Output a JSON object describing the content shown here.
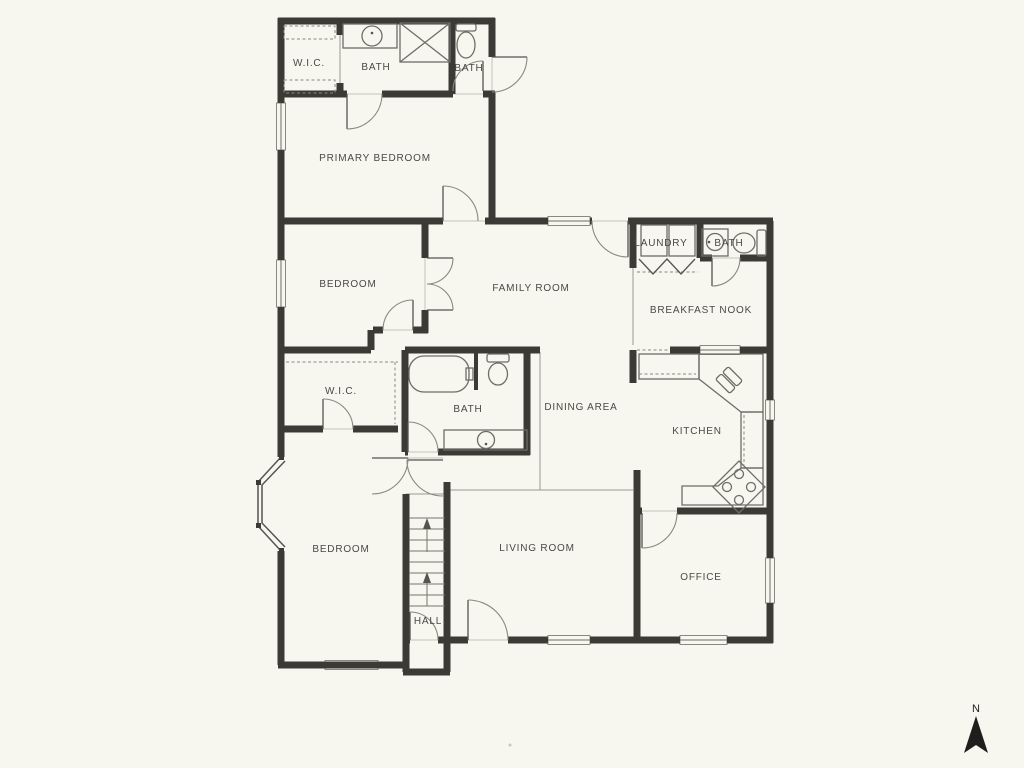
{
  "colors": {
    "background": "#F7F6EF",
    "wall": "#3B3A35",
    "line": "#8A897F",
    "light": "#C5C4BA",
    "text": "#4A4944",
    "accent_dark": "#22211E"
  },
  "rooms": [
    {
      "name": "wic-top",
      "label": "W.I.C."
    },
    {
      "name": "bath-primary",
      "label": "BATH"
    },
    {
      "name": "bath-top-right",
      "label": "BATH"
    },
    {
      "name": "primary-bedroom",
      "label": "PRIMARY BEDROOM"
    },
    {
      "name": "bedroom-middle",
      "label": "BEDROOM"
    },
    {
      "name": "family-room",
      "label": "FAMILY ROOM"
    },
    {
      "name": "laundry",
      "label": "LAUNDRY"
    },
    {
      "name": "bath-nook",
      "label": "BATH"
    },
    {
      "name": "breakfast-nook",
      "label": "BREAKFAST NOOK"
    },
    {
      "name": "wic-middle",
      "label": "W.I.C."
    },
    {
      "name": "bath-middle",
      "label": "BATH"
    },
    {
      "name": "dining-area",
      "label": "DINING AREA"
    },
    {
      "name": "kitchen",
      "label": "KITCHEN"
    },
    {
      "name": "bedroom-bottom",
      "label": "BEDROOM"
    },
    {
      "name": "living-room",
      "label": "LIVING ROOM"
    },
    {
      "name": "office",
      "label": "OFFICE"
    },
    {
      "name": "hall",
      "label": "HALL"
    }
  ],
  "compass": {
    "label": "N"
  },
  "fixtures": [
    "bathtub-icon",
    "shower-icon",
    "toilet-icon",
    "sink-icon",
    "washer-icon",
    "dryer-icon",
    "kitchen-sink-icon",
    "stove-icon",
    "stairs",
    "bay-window",
    "bifold-doors",
    "north-arrow"
  ]
}
